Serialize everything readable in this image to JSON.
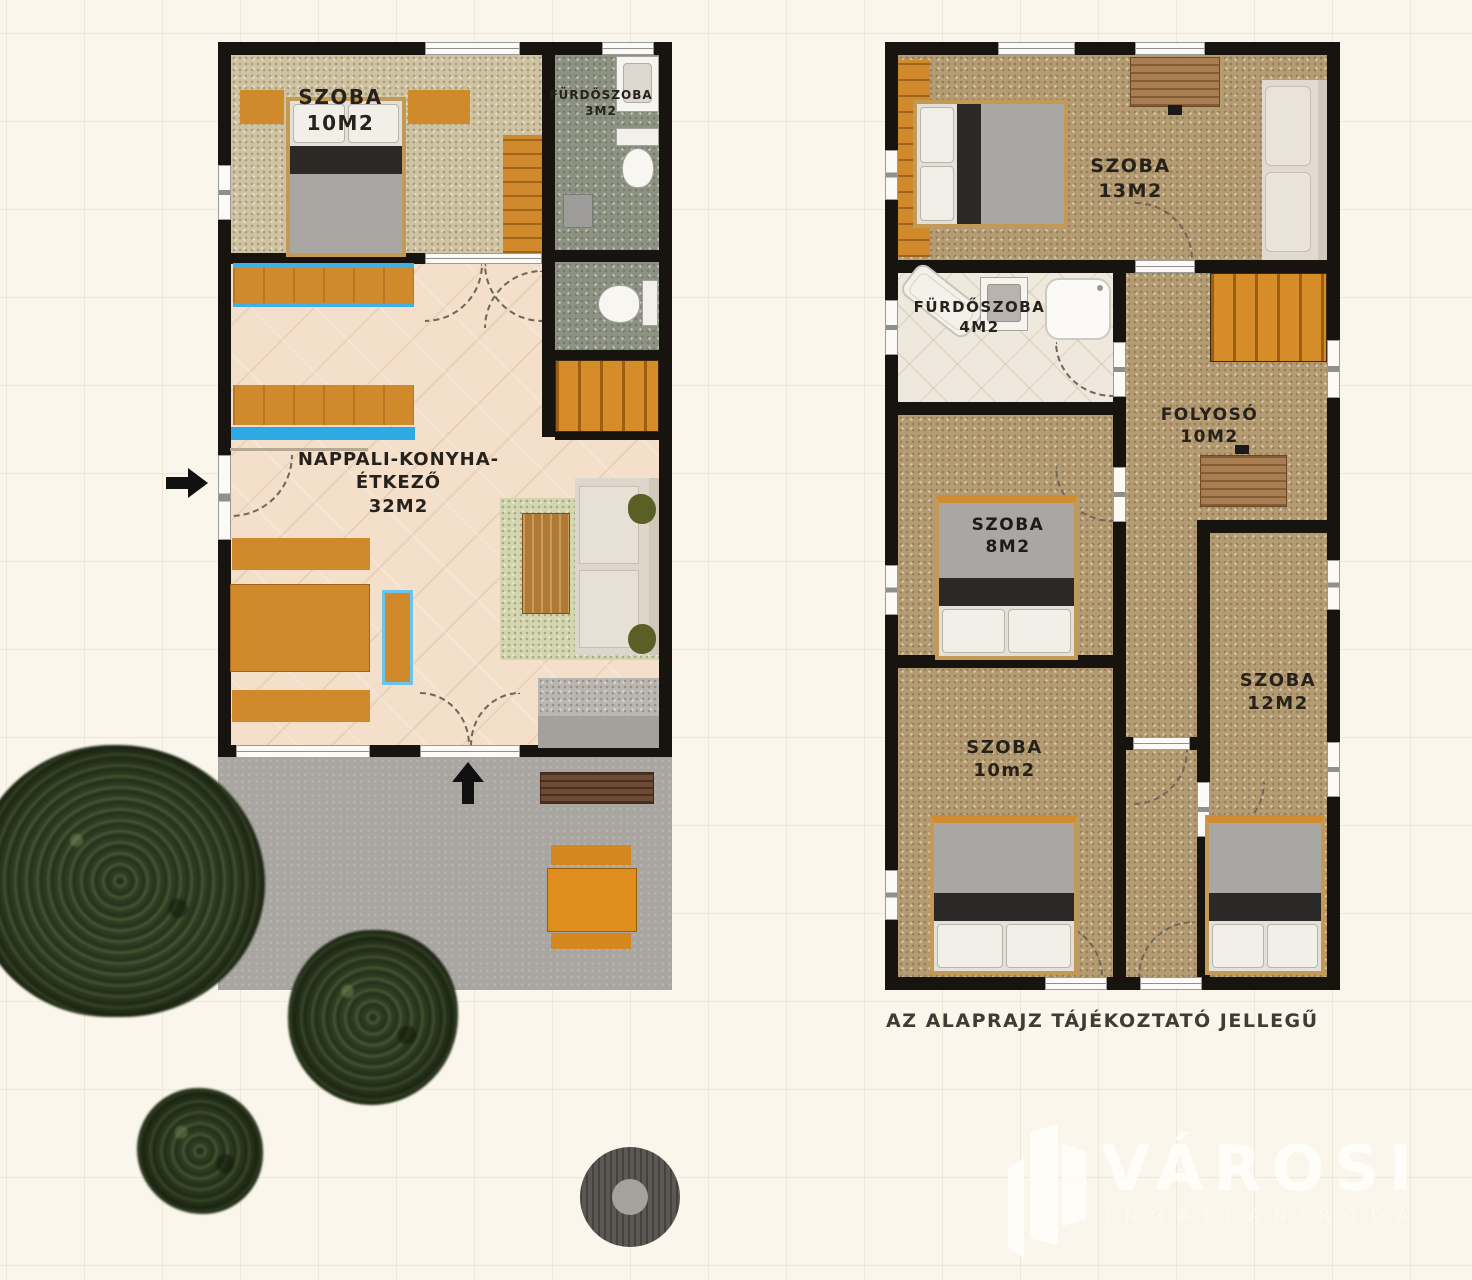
{
  "floor1": {
    "bedroom": {
      "name": "SZOBA",
      "area": "10M2"
    },
    "bathroom": {
      "name": "FÜRDŐSZOBA",
      "area": "3M2"
    },
    "living": {
      "name": "NAPPALI-KONYHA-ÉTKEZŐ",
      "area": "32M2"
    }
  },
  "floor2": {
    "bedroom13": {
      "name": "SZOBA",
      "area": "13M2"
    },
    "bathroom": {
      "name": "FÜRDŐSZOBA",
      "area": "4M2"
    },
    "hallway": {
      "name": "FOLYOSÓ",
      "area": "10M2"
    },
    "bedroom8": {
      "name": "SZOBA",
      "area": "8M2"
    },
    "bedroom10": {
      "name": "SZOBA",
      "area": "10m2"
    },
    "bedroom12": {
      "name": "SZOBA",
      "area": "12M2"
    }
  },
  "note": "AZ ALAPRAJZ TÁJÉKOZTATÓ JELLEGŰ",
  "watermark": {
    "brand": "VÁROSI",
    "tagline": "INGATLANIRODA"
  },
  "colors": {
    "wall": "#17140f",
    "furniture_orange": "#d08a2b",
    "counter_blue": "#3fb0e6",
    "ground_floor_tile": "#f3dfca",
    "upper_floor": "#b59b71",
    "bath_green": "#8d9383",
    "terrace_gray": "#a9a6a1",
    "background": "#faf6eb"
  }
}
